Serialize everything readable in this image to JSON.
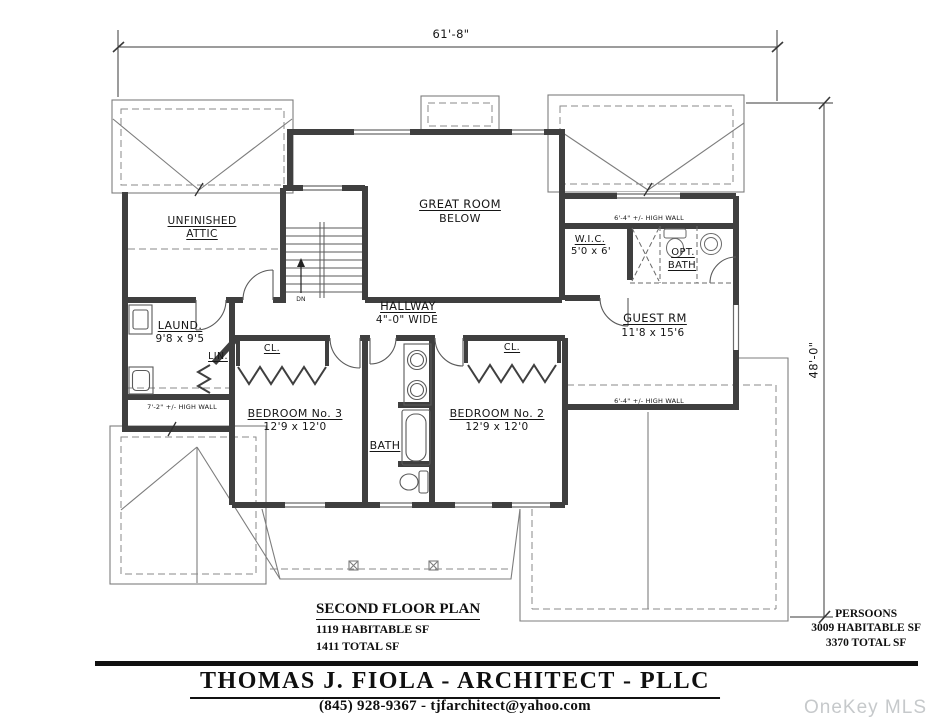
{
  "drawing": {
    "dim_width": "61'-8\"",
    "dim_height": "48'-0\"",
    "rooms": {
      "attic1": "UNFINISHED",
      "attic2": "ATTIC",
      "great1": "GREAT ROOM",
      "great2": "BELOW",
      "wic_name": "W.I.C.",
      "wic_size": "5'0 x 6'",
      "optbath1": "OPT.",
      "optbath2": "BATH",
      "guest_name": "GUEST RM",
      "guest_size": "11'8 x 15'6",
      "hall_name": "HALLWAY",
      "hall_size": "4\"-0\" WIDE",
      "laund_name": "LAUND.",
      "laund_size": "9'8 x 9'5",
      "lin": "LIN.",
      "cl3": "CL.",
      "cl2": "CL.",
      "bed3_name": "BEDROOM No. 3",
      "bed3_size": "12'9 x 12'0",
      "bed2_name": "BEDROOM No. 2",
      "bed2_size": "12'9 x 12'0",
      "bath": "BATH"
    },
    "notes": {
      "dn": "DN",
      "highwall_r_top": "6'-4\" +/- HIGH WALL",
      "highwall_r_bot": "6'-4\" +/- HIGH WALL",
      "highwall_l": "7'-2\" +/- HIGH WALL"
    }
  },
  "plan_title": {
    "title": "SECOND FLOOR PLAN",
    "habitable": "1119 HABITABLE SF",
    "total": "1411 TOTAL SF"
  },
  "project_totals": {
    "name": "PERSOONS",
    "habitable": "3009 HABITABLE SF",
    "total": "3370 TOTAL SF"
  },
  "title_block": {
    "firm": "THOMAS J. FIOLA - ARCHITECT - PLLC",
    "contact": "(845) 928-9367 - tjfarchitect@yahoo.com"
  },
  "watermark": "OneKey MLS",
  "colors": {
    "wall": "#3f3f3f",
    "thin_line": "#555555",
    "roof_line": "#7d7d7d",
    "watermark_text": "#c6c9cb"
  }
}
